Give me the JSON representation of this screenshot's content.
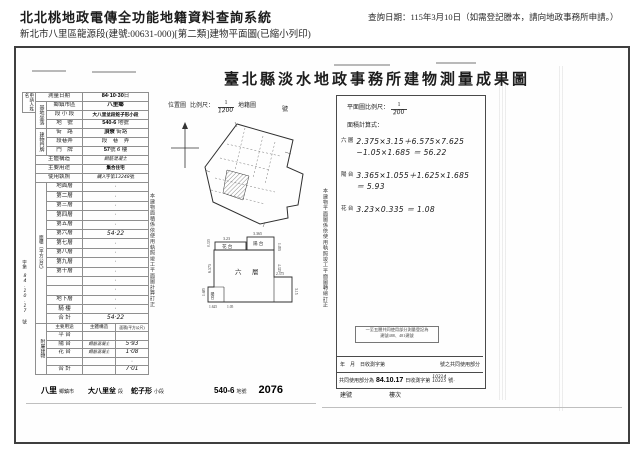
{
  "header": {
    "system_title": "北北桃地政電傳全功能地籍資料查詢系統",
    "query_date": "查詢日期：115年3月10日（如需登記謄本，請向地政事務所申請。）",
    "subtitle": "新北市八里區龍源段(建號:00631-000)[第二類]建物平面圖(已縮小列印)"
  },
  "doc": {
    "title": "臺北縣淡水地政事務所建物測量成果圖",
    "applicant_label": "申請人姓名",
    "info": {
      "survey_date_label": "測量日期",
      "survey_date_value": "84·10·30",
      "survey_date_suffix": "日",
      "site_label": "基地坐落",
      "township_label": "鄉鎮市區",
      "township_value": "八里鄉",
      "section_label": "段 小 段",
      "section_value_1": "大八里坌段",
      "section_value_2": "蛇子形小段",
      "lot_label": "地　號",
      "lot_value": "540-6",
      "lot_suffix": "地號",
      "address_label": "建物門牌",
      "street_label": "街　路",
      "street_value": "頂寮",
      "street_suffix": "街路",
      "lane_label": "段巷弄",
      "lane_value": "段　巷　弄",
      "door_label": "門　牌",
      "door_value_no": "57",
      "door_no_suffix": "號",
      "door_value_fl": "6",
      "door_fl_suffix": "樓",
      "structure_label": "主體構造",
      "structure_value": "鋼筋混凝土",
      "use_label": "主要用途",
      "use_value": "集合住宅",
      "license_label": "使用執照",
      "license_hand1": "購入",
      "license_mid": "字第",
      "license_hand2": "13248",
      "license_suffix": "號"
    },
    "area_label": "面積（平方公尺）",
    "floors": [
      {
        "name": "地面層",
        "value": "·"
      },
      {
        "name": "第二層",
        "value": "·"
      },
      {
        "name": "第三層",
        "value": "·"
      },
      {
        "name": "第四層",
        "value": "·"
      },
      {
        "name": "第五層",
        "value": "·"
      },
      {
        "name": "第六層",
        "value": "54·22"
      },
      {
        "name": "第七層",
        "value": "·"
      },
      {
        "name": "第八層",
        "value": "·"
      },
      {
        "name": "第九層",
        "value": "·"
      },
      {
        "name": "第十層",
        "value": "·"
      },
      {
        "name": "",
        "value": "·"
      },
      {
        "name": "",
        "value": "·"
      },
      {
        "name": "地下層",
        "value": "·"
      },
      {
        "name": "騎 樓",
        "value": "·"
      },
      {
        "name": "合 計",
        "value": "54·22"
      }
    ],
    "annex": {
      "label": "附屬建物",
      "use_header": "主要用途",
      "struct_header": "主體構造",
      "area_header": "面積(平方公尺)",
      "rows": [
        {
          "use": "平 台",
          "struct": "",
          "area": ""
        },
        {
          "use": "陽 台",
          "struct": "鋼筋混凝土",
          "area": "5·93"
        },
        {
          "use": "花 台",
          "struct": "鋼筋混凝土",
          "area": "1·08"
        },
        {
          "use": "",
          "struct": "",
          "area": "·"
        },
        {
          "use": "合 計",
          "struct": "",
          "area": "7·01"
        }
      ]
    },
    "receipt": {
      "printed_prefix": "字第",
      "hand_date": "84.10.17",
      "printed_suffix": "號"
    },
    "note_left": "本建物面積係依使用執照竣工平面圖計算訂正",
    "note_right": "本建物平面圖係依使用執照竣工平面圖轉繪訂正",
    "location_map": {
      "map_label": "位置圖",
      "scale_label": "比例尺：",
      "scale_num": "1",
      "scale_den": "1200",
      "cadastral_label": "地籍圖",
      "no_label": "號"
    },
    "plan": {
      "scale_label": "平面圖比例尺：",
      "scale_num": "1",
      "scale_den": "200",
      "calc_label": "面積計算式：",
      "entries": [
        {
          "label": "六 層",
          "line1": "2.375×3.15＋6.575×7.625",
          "line2": "−1.05×1.685 ＝ 56.22"
        },
        {
          "label": "陽 台",
          "line1": "3.365×1.055＋1.625×1.685",
          "line2": "＝ 5.93"
        },
        {
          "label": "花 台",
          "line1": "3.23×0.335 ＝ 1.08",
          "line2": ""
        }
      ],
      "labels": {
        "sixth": "六　層",
        "balcony_top": "陽 台",
        "flower": "花 台",
        "balcony_bl": "陽台"
      },
      "dims": [
        "3.23",
        "3.365",
        "0.335",
        "1.055",
        "6.575",
        "4.325",
        "2.375",
        "3.15",
        "1.685",
        "1.625",
        "1.05"
      ]
    },
    "stamp": {
      "line1": "一至五層共同使用部分測量登記為",
      "line2": "建號488、481建號"
    },
    "common": {
      "row1_left": "年　月　日收測字第",
      "row1_right": "號之共同使用部分",
      "row2_prefix": "共同使用部分為",
      "row2_date": "84.10.17",
      "row2_mid": "日收測字第",
      "row2_no1": "10314",
      "row2_no2": "10315",
      "row2_suffix": "號·"
    },
    "footer_labels": {
      "building_no": "建號",
      "floor_no": "樓次"
    },
    "land_strip": [
      {
        "value": "八里",
        "label": "鄉鎮市"
      },
      {
        "value": "大八里坌",
        "label": "段"
      },
      {
        "value": "蛇子形",
        "label": "小段"
      },
      {
        "value": "540-6",
        "label": "地號"
      },
      {
        "value": "2076",
        "label": ""
      }
    ]
  }
}
